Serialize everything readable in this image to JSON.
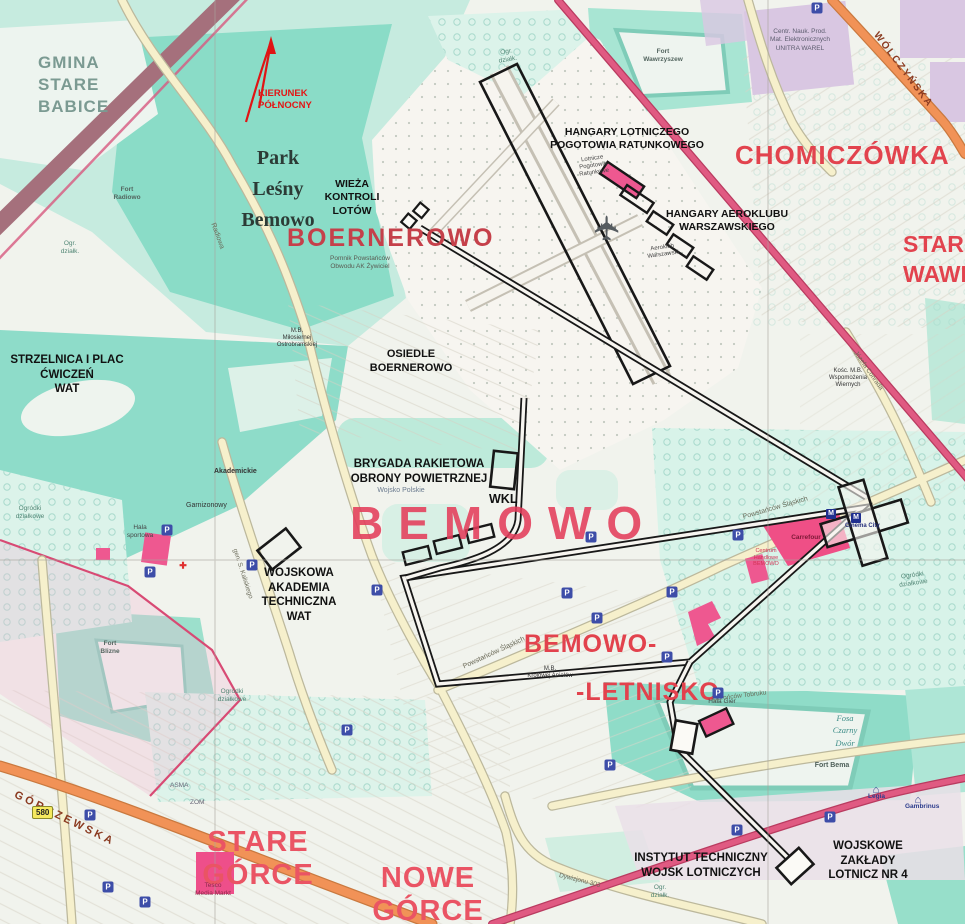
{
  "north": {
    "label": "KIERUNEK\nPÓŁNOCNY"
  },
  "region": {
    "gmina": "GMINA\nSTARE\nBABICE",
    "park_lesny": "Park\nLeśny\nBemowo",
    "boernerowo": "BOERNEROWO",
    "chomiczowka": "CHOMICZÓWKA",
    "stare_wawrzyszew": "STARE\nWAWRZYSZEW",
    "bemowo": "BEMOWO",
    "bemowo_letnisko_top": "BEMOWO-",
    "bemowo_letnisko_bottom": "-LETNISKO",
    "stare_gorce": "STARE\nGÓRCE",
    "nowe_gorce": "NOWE\nGÓRCE"
  },
  "military": {
    "wieza": "WIEŻA\nKONTROLI\nLOTÓW",
    "hangary_lpr": "HANGARY LOTNICZEGO\nPOGOTOWIA RATUNKOWEGO",
    "hangary_aeroklub": "HANGARY AEROKLUBU\nWARSZAWSKIEGO",
    "strzelnica": "STRZELNICA I PLAC\nĆWICZEŃ\nWAT",
    "osiedle_boernerowo": "OSIEDLE\nBOERNEROWO",
    "brygada": "BRYGADA RAKIETOWA\nOBRONY POWIETRZNEJ",
    "wojsko_polskie": "Wojsko Polskie",
    "wkl": "WKL",
    "wat": "WOJSKOWA\nAKADEMIA\nTECHNICZNA\nWAT",
    "instytut": "INSTYTUT TECHNICZNY\nWOJSK LOTNICZYCH",
    "wzl": "WOJSKOWE ZAKŁADY\nLOTNICZ NR 4"
  },
  "places": {
    "fort_radiowo": "Fort\nRadiowo",
    "fort_wawrzyszew": "Fort\nWawrzyszew",
    "fort_blizne": "Fort\nBlizne",
    "fort_bema": "Fort Bema",
    "fosa_czarny_dwor": "Fosa\nCzarny\nDwór",
    "unitra": "Centr. Nauk. Prod.\nMat. Elektronicznych\nUNITRA WAREL",
    "carrefour": "Carrefour",
    "centrum_handlowe": "Centrum\nHandlowe\nBEMOWO",
    "cinema_city": "Cinema City",
    "hala_sportowa": "Hala\nsportowa",
    "hala_gier": "Hala Gier",
    "tesco": "Tesco\nMedia Markt",
    "legia": "Legia",
    "gambrinus": "Gambrinus",
    "asma": "ASMA",
    "zom": "ZOM",
    "akademickie": "Akademickie",
    "garnizonowy": "Garnizonowy",
    "pomnik": "Pomnik Powstańców\nObwodu AK Żywiciel",
    "mb_milosiernej": "M.B.\nMiłosiernej\nOstrobramskiej",
    "mb_krolowej": "M.B.\nKrólowej Aniołów",
    "kosc_wspomozenia": "Kośc. M.B.\nWspomożenia\nWiernych",
    "aeroklub": "Aeroklub\nWarszawski",
    "lpr": "Lotnicze\nPogotowie\nRatunkowe",
    "ogrodki": "Ogródki\ndziałkowe",
    "ogr_dzialk": "Ogr.\ndziałk."
  },
  "streets": {
    "gorczewska": "GÓRCZEWSKA",
    "wolczynska": "WÓLCZYŃSKA",
    "powstancow": "Powstańców Śląskich",
    "radiowa": "Radiowa",
    "kaliskiego": "gen. S. Kaliskiego",
    "conrada": "Józefa Conrada",
    "obroncow_tobruku": "Obrońców Tobruku",
    "dywizjonu_303": "Dywizjonu 303",
    "road_580": "580"
  },
  "icons": {
    "parking": "P",
    "metro": "M",
    "plane": "✈",
    "house": "⌂",
    "cross": "✚"
  },
  "colors": {
    "label_red": "#e2434e",
    "label_pink": "#ea5464",
    "annotation": "#1a1a1a",
    "road_pink": "#e05a82",
    "road_orange": "#f19257",
    "park_teal": "#8adcc7",
    "north_red": "#e01414",
    "building_pink": "#ee5890"
  }
}
